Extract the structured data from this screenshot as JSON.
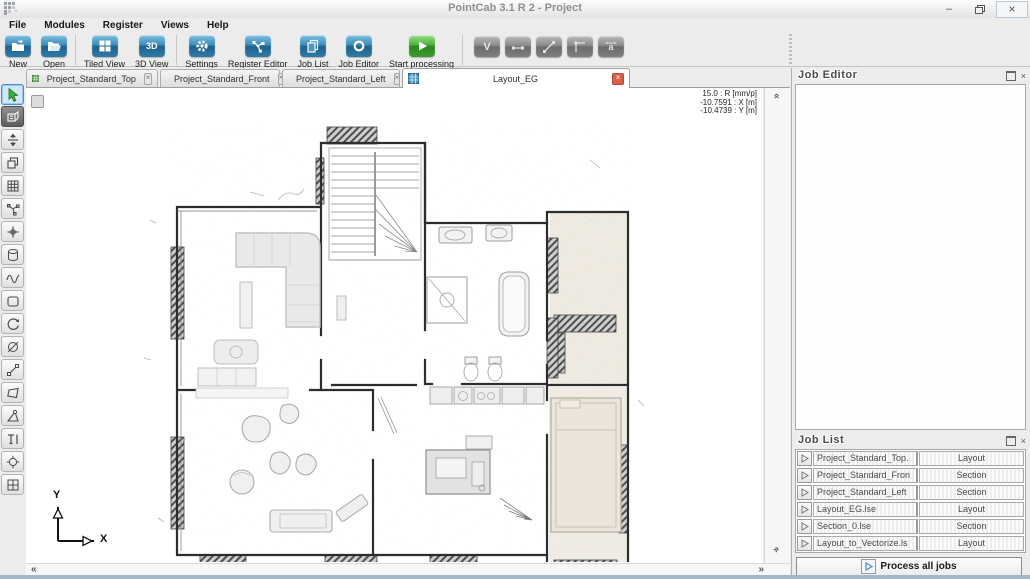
{
  "window": {
    "title": "PointCab 3.1 R 2 - Project"
  },
  "menu": {
    "items": [
      "File",
      "Modules",
      "Register",
      "Views",
      "Help"
    ]
  },
  "toolbar": {
    "buttons": [
      {
        "label": "New"
      },
      {
        "label": "Open"
      },
      {
        "label": "Tiled View"
      },
      {
        "label": "3D View",
        "icon_text": "3D"
      },
      {
        "label": "Settings"
      },
      {
        "label": "Register Editor"
      },
      {
        "label": "Job List"
      },
      {
        "label": "Job Editor"
      },
      {
        "label": "Start processing"
      }
    ],
    "disabled_tools": [
      {
        "name": "vectorizer",
        "glyph": "V"
      },
      {
        "name": "line-tool"
      },
      {
        "name": "polyline-tool"
      },
      {
        "name": "corner-tool"
      },
      {
        "name": "dimension-tool",
        "glyph": "a"
      }
    ]
  },
  "tabs": [
    {
      "label": "Project_Standard_Top",
      "active": false
    },
    {
      "label": "Project_Standard_Front",
      "active": false
    },
    {
      "label": "Project_Standard_Left",
      "active": false
    },
    {
      "label": "Layout_EG",
      "active": true
    }
  ],
  "canvas": {
    "overlay": {
      "lines": [
        "15.0 : R [mm/p]",
        "-10.7591 : X [m]",
        "-10.4739 : Y [m]"
      ]
    },
    "axis": {
      "x": "X",
      "y": "Y"
    }
  },
  "panels": {
    "job_editor": {
      "title": "Job Editor"
    },
    "job_list": {
      "title": "Job List",
      "rows": [
        {
          "name": "Project_Standard_Top.",
          "type": "Layout"
        },
        {
          "name": "Project_Standard_Fron",
          "type": "Section"
        },
        {
          "name": "Project_Standard_Left",
          "type": "Section"
        },
        {
          "name": "Layout_EG.lse",
          "type": "Layout"
        },
        {
          "name": "Section_0.lse",
          "type": "Section"
        },
        {
          "name": "Layout_to_Vectorize.ls",
          "type": "Layout"
        }
      ],
      "process_all_label": "Process all jobs"
    }
  },
  "glyphs": {
    "minimize": "–",
    "close": "×",
    "tab_close": "×",
    "chevron_left": "«",
    "chevron_right": "»",
    "chevron_up": "«"
  },
  "colors": {
    "accent_blue": "#2e7fae",
    "accent_green": "#3aa63a",
    "tab_close_red": "#d9604a",
    "selection_blue": "#3f8fd6"
  }
}
